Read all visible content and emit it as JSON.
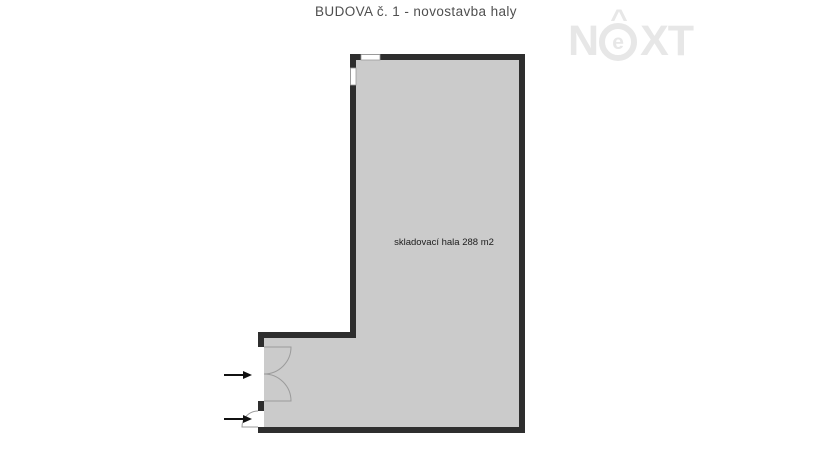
{
  "title": "BUDOVA č. 1 - novostavba haly",
  "logo": {
    "letter1": "N",
    "letter2": "e",
    "letter3": "X",
    "letter4": "T",
    "hat": "^"
  },
  "floor_plan": {
    "room_label": "skladovací hala 288 m2"
  },
  "colors": {
    "wall": "#2e2e2e",
    "interior": "#cbcbcb",
    "door_line": "#9b9b9b",
    "window_border": "#9b9b9b",
    "arrow": "#111111",
    "title_text": "#4f4f4f",
    "label_text": "#1c1c1c",
    "logo": "#e7e7e7",
    "background": "#ffffff"
  }
}
